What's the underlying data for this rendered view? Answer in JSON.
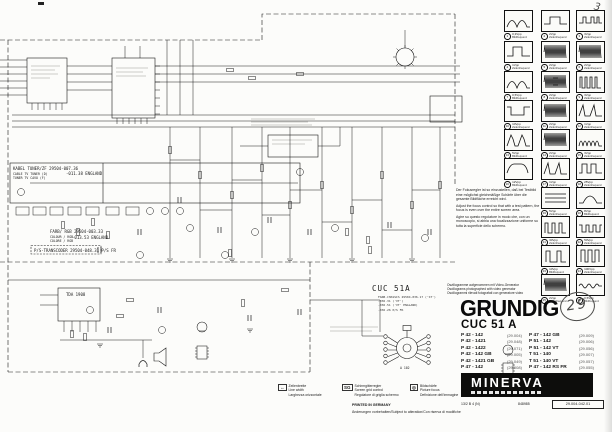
{
  "page": {
    "pencil_page_mark": "3",
    "pencil_revision": "29"
  },
  "modules": {
    "cable_tuner": {
      "title": "KABEL TUNER/ZF 29504-007.36",
      "title2": "-011.38 ENGLAND",
      "sub1": "CABLE TV TUNER (D)",
      "sub2": "TUNER TV CAVO (F)"
    },
    "colour_rgb": {
      "title": "FARB/ RGB 29504-003.33",
      "title2": "-013.53 ENGLAND",
      "sub1": "COLOUR / RGB",
      "sub2": "COLORE / RGB"
    },
    "ps_transcoder": {
      "title": "P/S-TRANSCODER 29504-048.31 P/S FR"
    },
    "chassis": {
      "label": "CUC 51A",
      "notes": [
        "FARB-CHASSIS 29504-036.17 ('ST')",
        "-036.31 ('VT')",
        "-036.51 ('VT' ENGLAND)",
        "-036.26 P/S FR"
      ]
    },
    "audio_ic": {
      "label": "TDA 1908"
    },
    "crt_socket": {
      "label": "A 102"
    }
  },
  "focus_note": {
    "de": "Der Fokusregler ist so einzustellen, daß bei Testbild eine möglichst gleichmäßige Schärfe über die gesamte Bildfläche erreicht wird.",
    "en": "Adjust the focus control so that with a test pattern, the focus is even over the entire screen area.",
    "it": "Agire su questo regolatore in modo che, con un monoscopio, si abbia una focalizzazione uniforme su tutta la superficie dello schermo."
  },
  "osc_note": {
    "de": "Oszillogramme aufgenommen mit Video-Generator",
    "en": "Oscillograms photographed with video generator",
    "it": "Oscillogrammi rilevati fotografati con generatore video"
  },
  "oscillograms": [
    {
      "n": "1",
      "r": 0,
      "c": 0,
      "k": "sine2",
      "v": "0,3Vpp",
      "f": "Bildfrequenz"
    },
    {
      "n": "2",
      "r": 0,
      "c": 1,
      "k": "step",
      "v": "2Vpp",
      "f": "Zeilenfrequenz"
    },
    {
      "n": "3",
      "r": 0,
      "c": 2,
      "k": "pulseflat",
      "v": "3Vpp",
      "f": "Zeilenfrequenz"
    },
    {
      "n": "4",
      "r": 1,
      "c": 0,
      "k": "sq",
      "v": "1Vpp",
      "f": "Zeilenfrequenz"
    },
    {
      "n": "5",
      "r": 1,
      "c": 1,
      "k": "burst",
      "v": "2Vpp",
      "f": "Zeilenfrequenz"
    },
    {
      "n": "6",
      "r": 1,
      "c": 2,
      "k": "burst",
      "v": "2Vpp",
      "f": "Zeilenfrequenz"
    },
    {
      "n": "7",
      "r": 2,
      "c": 0,
      "k": "sine2",
      "v": "0,5Vpp",
      "f": "Bildfrequenz"
    },
    {
      "n": "8",
      "r": 2,
      "c": 1,
      "k": "burstmid",
      "v": "2Vpp",
      "f": "Zeilenfrequenz"
    },
    {
      "n": "9",
      "r": 2,
      "c": 2,
      "k": "comb4",
      "v": "3Vpp",
      "f": "Zeilenfrequenz"
    },
    {
      "n": "10",
      "r": 3,
      "c": 0,
      "k": "negpulse",
      "v": "10Vpp",
      "f": "Zeilenfrequenz"
    },
    {
      "n": "11",
      "r": 3,
      "c": 1,
      "k": "burst",
      "v": "2Vpp",
      "f": "Zeilenfrequenz"
    },
    {
      "n": "12",
      "r": 3,
      "c": 2,
      "k": "spikes2",
      "v": "1Vpp",
      "f": "Zeilenfrequenz"
    },
    {
      "n": "13",
      "r": 4,
      "c": 0,
      "k": "twinpeak",
      "v": "5Vpp",
      "f": "Bildfrequenz"
    },
    {
      "n": "14",
      "r": 4,
      "c": 1,
      "k": "burst",
      "v": "2Vpp",
      "f": "Zeilenfrequenz"
    },
    {
      "n": "15",
      "r": 4,
      "c": 2,
      "k": "combhump",
      "v": "3Vpp",
      "f": "Zeilenfrequenz"
    },
    {
      "n": "16",
      "r": 5,
      "c": 0,
      "k": "roundsq",
      "v": "12Vpp",
      "f": "Bildfrequenz"
    },
    {
      "n": "17",
      "r": 5,
      "c": 1,
      "k": "spikes2",
      "v": "1Vpp",
      "f": "Zeilenfrequenz"
    },
    {
      "n": "18",
      "r": 5,
      "c": 2,
      "k": "sq2",
      "v": "25Vpp",
      "f": "Zeilenfrequenz"
    },
    {
      "n": "19",
      "r": 6,
      "c": 1,
      "k": "flatlines",
      "v": "5Vpp",
      "f": "Zeilenfrequenz"
    },
    {
      "n": "20",
      "r": 6,
      "c": 2,
      "k": "parabola",
      "v": "8Vpp",
      "f": "Bildfrequenz"
    },
    {
      "n": "21",
      "r": 7,
      "c": 1,
      "k": "comb3",
      "v": "30Vpp",
      "f": "Zeilenfrequenz"
    },
    {
      "n": "22",
      "r": 7,
      "c": 2,
      "k": "combsq",
      "v": "50Vpp",
      "f": "Zeilenfrequenz"
    },
    {
      "n": "23",
      "r": 8,
      "c": 1,
      "k": "comb2",
      "v": "10Vpp",
      "f": "Bildfrequenz"
    },
    {
      "n": "24",
      "r": 8,
      "c": 2,
      "k": "bars3",
      "v": "100Vpp",
      "f": "Zeilenfrequenz"
    },
    {
      "n": "25",
      "r": 9,
      "c": 1,
      "k": "burst",
      "v": "2Vpp",
      "f": "Zeilenfrequenz"
    },
    {
      "n": "26",
      "r": 9,
      "c": 2,
      "k": "sinesmall",
      "v": "0,5Vpp",
      "f": "Bildfrequenz"
    }
  ],
  "brand": {
    "logo": "GRUNDIG",
    "chassis": "CUC 51 A",
    "models_left": [
      {
        "name": "P 42 - 142",
        "no": "(29.004)"
      },
      {
        "name": "P 42 - 1421",
        "no": "(29.048)"
      },
      {
        "name": "P 42 - 1422",
        "no": "(29.071)"
      },
      {
        "name": "P 42 - 142 GB",
        "no": "(29.005)"
      },
      {
        "name": "P 42 - 1421 GB",
        "no": "(29.049)"
      },
      {
        "name": "P 47 - 142",
        "no": "(29.008)"
      }
    ],
    "models_right": [
      {
        "name": "P 47 - 142 GB",
        "no": "(29.009)"
      },
      {
        "name": "P 51 - 142",
        "no": "(29.006)"
      },
      {
        "name": "P 51 - 142 VT",
        "no": "(29.056)"
      },
      {
        "name": "T 51 - 140",
        "no": "(29.007)"
      },
      {
        "name": "T 51 - 140 VT",
        "no": "(29.057)"
      },
      {
        "name": "P 47 - 142 RS FR",
        "no": "(29.055)"
      }
    ],
    "banner": "MINERVA",
    "footer_left": "13/2 B 4 (N)",
    "footer_mid": "848985",
    "footer_box": "29.004-042.01"
  },
  "legend": {
    "items": [
      {
        "icon": "line-width",
        "sym": "↔",
        "de": "Zeilenbreite",
        "en": "Line width",
        "it": "Larghezza orizzontale"
      },
      {
        "icon": "screen-grid",
        "sym": "SG",
        "de": "Schirmgitterregler",
        "en": "Screen grid control",
        "it": "Regolatore di griglia schermo"
      },
      {
        "icon": "focus",
        "sym": "◎",
        "de": "Bildschärfe",
        "en": "Picture focus",
        "it": "Definizione dell'immagine"
      }
    ],
    "printed": "PRINTED IN GERMANY",
    "alterations": "Änderungen vorbehalten/Subject to alteration/Con riserva di modifiche"
  }
}
